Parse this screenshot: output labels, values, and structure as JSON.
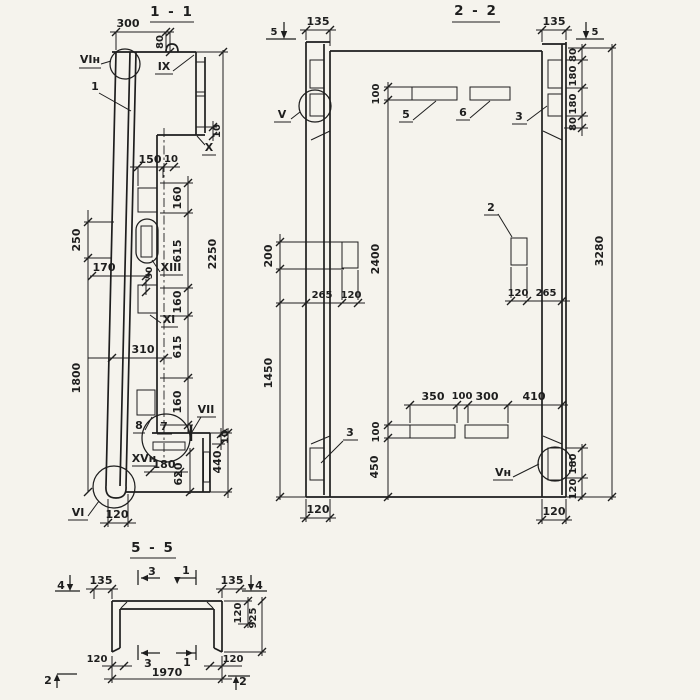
{
  "colors": {
    "paper": "#f5f3ed",
    "ink": "#1e1e1e"
  },
  "s1": {
    "title": "1 - 1",
    "c_vin": "VIн",
    "c_ix": "IX",
    "c_1": "1",
    "c_x": "X",
    "c_xiii": "XIII",
    "c_xi": "XI",
    "c_vii": "VII",
    "c_xvn": "XVн",
    "c_vi": "VI",
    "c_7": "7",
    "c_8": "8",
    "d_300": "300",
    "d_80": "80",
    "d_10_top": "10",
    "d_150": "150",
    "d_10_step": "10",
    "d_160a": "160",
    "d_615a": "615",
    "d_160b": "160",
    "d_615b": "615",
    "d_160c": "160",
    "d_2250": "2250",
    "d_250": "250",
    "d_1800": "1800",
    "d_170": "170",
    "d_50": "50",
    "d_310": "310",
    "d_10_bot": "10",
    "d_180": "180",
    "d_620": "620",
    "d_440": "440",
    "d_120": "120"
  },
  "s2": {
    "title": "2 - 2",
    "m_5l": "5",
    "m_5r": "5",
    "c_v": "V",
    "c_vn": "Vн",
    "c_2": "2",
    "c_3t": "3",
    "c_3b": "3",
    "c_5": "5",
    "c_6": "6",
    "d_135l": "135",
    "d_135r": "135",
    "d_80t": "80",
    "d_180t1": "180",
    "d_180t2": "180",
    "d_80b": "80",
    "d_3280": "3280",
    "d_180_br": "180",
    "d_120_br": "120",
    "d_100_top": "100",
    "d_2400": "2400",
    "d_100_bot": "100",
    "d_450": "450",
    "d_200": "200",
    "d_1450": "1450",
    "d_265_left": "265",
    "d_120_left_patch": "120",
    "d_120_right_patch": "120",
    "d_265_right": "265",
    "d_350": "350",
    "d_100_mid": "100",
    "d_300": "300",
    "d_410": "410",
    "d_120_rib_left": "120",
    "d_120_rib_right": "120"
  },
  "s5": {
    "title": "5 - 5",
    "m_4l": "4",
    "m_4r": "4",
    "m_3t": "3",
    "m_1t": "1",
    "m_3b": "3",
    "m_1b": "1",
    "m_2l": "2",
    "m_2r": "2",
    "d_135l": "135",
    "d_135r": "135",
    "d_120r": "120",
    "d_925": "925",
    "d_120bl": "120",
    "d_120br": "120",
    "d_1970": "1970"
  }
}
